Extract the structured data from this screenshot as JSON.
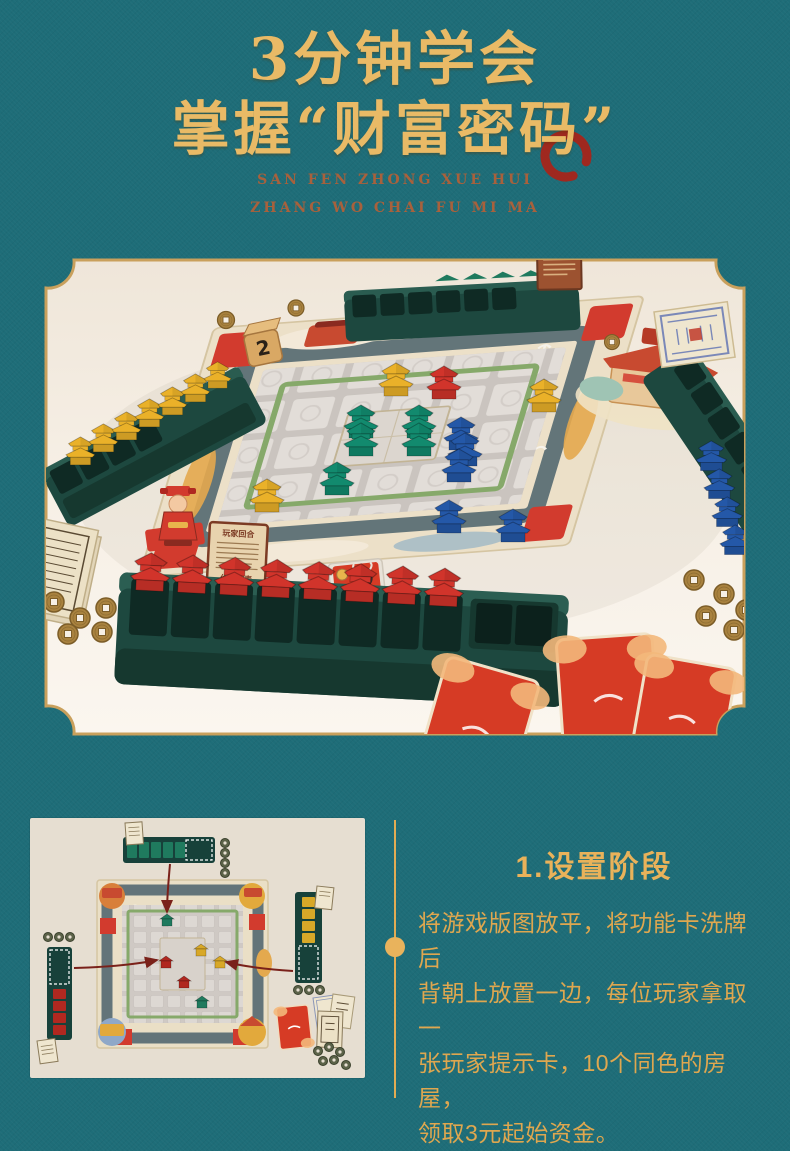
{
  "header": {
    "title_line1": "3分钟学会",
    "title_line2": "掌握“财富密码”",
    "pinyin_line1": "SAN FEN ZHONG XUE HUI",
    "pinyin_line2": "ZHANG WO CHAI FU MI MA"
  },
  "photo": {
    "die_value": "2",
    "hint_card": {
      "title": "玩家回合",
      "subtitle": "价格列表"
    }
  },
  "step": {
    "heading": "1.设置阶段",
    "body": "将游戏版图放平，将功能卡洗牌后\n背朝上放置一边，每位玩家拿取一\n张玩家提示卡，10个同色的房屋，\n领取3元起始资金。"
  },
  "colors": {
    "background_teal": "#1e6d78",
    "title_gold": "#e9ba66",
    "body_gold": "#dfa74f",
    "pinyin_brown": "#a8613c",
    "seal_red": "#aa2318",
    "frame_gold": "#c9a05c",
    "photo_cream": "#f6efe5",
    "diagram_beige": "#e6ded1",
    "tray_green": "#1d483f",
    "house_yellow": "#eab129",
    "house_red": "#d1342b",
    "house_green": "#128a6e",
    "house_blue": "#2458a8",
    "coin_brass": "#a9823f"
  }
}
